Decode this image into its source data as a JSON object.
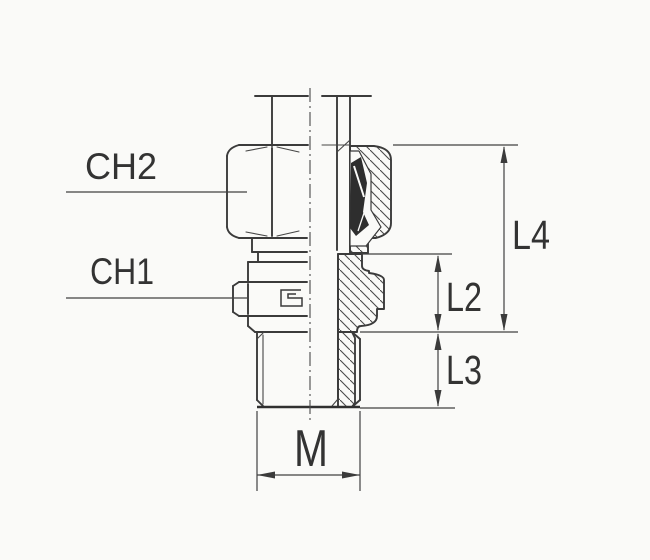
{
  "diagram": {
    "kind": "technical-drawing",
    "callouts": {
      "ch2": "CH2",
      "ch1": "CH1"
    },
    "dimensions": {
      "l4": "L4",
      "l2": "L2",
      "l3": "L3",
      "m": "M"
    },
    "colors": {
      "line": "#3b3b3b",
      "text": "#333333",
      "paper": "#fafaf8",
      "section_dark": "#2e2e2e"
    }
  }
}
